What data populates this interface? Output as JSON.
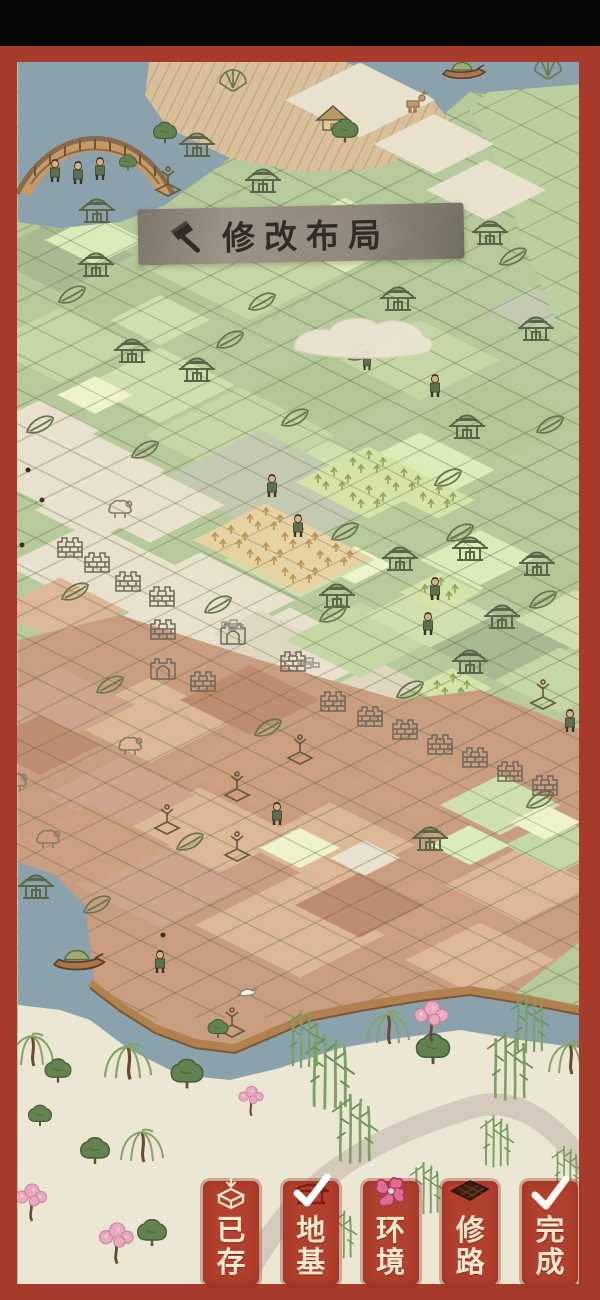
{
  "banner": {
    "label": "修改布局",
    "icon": "hammer-icon",
    "bg_color": "#8d8279",
    "text_color": "#322b21"
  },
  "toolbar": {
    "button_color": "#b2402e",
    "label_color": "#f3e8d0",
    "buttons": [
      {
        "id": "saved",
        "label": "已存",
        "chars": [
          "已",
          "存"
        ],
        "icon": "save-box-icon",
        "selected": false
      },
      {
        "id": "foundation",
        "label": "地基",
        "chars": [
          "地",
          "基"
        ],
        "icon": "building-check-icon",
        "selected": true
      },
      {
        "id": "environment",
        "label": "环境",
        "chars": [
          "环",
          "境"
        ],
        "icon": "flower-icon",
        "selected": false
      },
      {
        "id": "road",
        "label": "修路",
        "chars": [
          "修",
          "路"
        ],
        "icon": "road-tile-icon",
        "selected": false
      },
      {
        "id": "finish",
        "label": "完成",
        "chars": [
          "完",
          "成"
        ],
        "icon": "check-icon",
        "selected": false
      }
    ]
  },
  "frame": {
    "border_color": "#a63b2b",
    "top_bar_color": "#070707"
  },
  "scene": {
    "palette": {
      "lg": "#cfe0ae",
      "ml": "#c5d7a4",
      "mg": "#b3c795",
      "sg": "#a6bb92",
      "pg": "#dcecb8",
      "yg": "#eef3cb",
      "cr": "#e8e1cd",
      "cd": "#ded7c2",
      "gs": "#c2cbb2",
      "tl": "#dcb896",
      "td": "#cc9f7f",
      "tp": "#cfa48d",
      "tb": "#bd8e6e",
      "pt": "#e6d2a2",
      "pgn": "#d4e4a9",
      "water": "#8ba2ad",
      "bank": "#ece6d4",
      "dirt": "#c99e80",
      "base_green": "#b7ca9b"
    },
    "patches_upper": [
      [
        "sg",
        60,
        255,
        150
      ],
      [
        "mg",
        140,
        300,
        160
      ],
      [
        "ml",
        250,
        265,
        220
      ],
      [
        "pg",
        345,
        235,
        150
      ],
      [
        "ml",
        60,
        345,
        150
      ],
      [
        "lg",
        160,
        385,
        150
      ],
      [
        "ml",
        240,
        435,
        190
      ],
      [
        "mg",
        330,
        390,
        160
      ],
      [
        "ml",
        420,
        360,
        160
      ],
      [
        "mg",
        500,
        420,
        160
      ],
      [
        "lg",
        330,
        480,
        160
      ],
      [
        "pg",
        420,
        470,
        150
      ],
      [
        "lg",
        160,
        320,
        100
      ],
      [
        "pg",
        95,
        240,
        100
      ],
      [
        "gs",
        260,
        480,
        200
      ],
      [
        "gs",
        320,
        500,
        140
      ],
      [
        "cr",
        70,
        470,
        190
      ],
      [
        "cr",
        150,
        505,
        150
      ],
      [
        "cr",
        90,
        565,
        170
      ],
      [
        "cr",
        40,
        430,
        120
      ],
      [
        "cr",
        95,
        510,
        120
      ],
      [
        "cr",
        200,
        600,
        190
      ],
      [
        "cr",
        290,
        655,
        190
      ],
      [
        "cd",
        380,
        700,
        150
      ],
      [
        "cd",
        260,
        640,
        120
      ],
      [
        "cr",
        150,
        640,
        150
      ],
      [
        "yg",
        355,
        565,
        75
      ],
      [
        "yg",
        95,
        395,
        75
      ],
      [
        "lg",
        300,
        560,
        150
      ],
      [
        "pg",
        480,
        560,
        120
      ],
      [
        "ml",
        360,
        640,
        150
      ],
      [
        "sg",
        500,
        645,
        150
      ],
      [
        "mg",
        540,
        585,
        120
      ],
      [
        "lg",
        430,
        615,
        130
      ],
      [
        "ml",
        560,
        680,
        130
      ],
      [
        "mg",
        430,
        720,
        150
      ],
      [
        "ml",
        540,
        765,
        120
      ],
      [
        "lg",
        330,
        770,
        120
      ],
      [
        "lg",
        575,
        620,
        120
      ],
      [
        "tl",
        60,
        610,
        130
      ],
      [
        "pt",
        265,
        522,
        74
      ],
      [
        "pt",
        300,
        540,
        74
      ],
      [
        "pt",
        335,
        558,
        74
      ],
      [
        "pt",
        265,
        557,
        74
      ],
      [
        "pt",
        300,
        575,
        74
      ],
      [
        "pt",
        230,
        540,
        74
      ],
      [
        "pgn",
        333,
        482,
        74
      ],
      [
        "pgn",
        368,
        465,
        74
      ],
      [
        "pgn",
        403,
        483,
        74
      ],
      [
        "pgn",
        368,
        500,
        74
      ],
      [
        "pgn",
        438,
        500,
        74
      ],
      [
        "gs",
        532,
        310,
        90
      ],
      [
        "pgn",
        440,
        592,
        80
      ],
      [
        "pgn",
        452,
        688,
        80
      ]
    ],
    "patches_lower": [
      [
        "tl",
        150,
        720,
        170
      ],
      [
        "td",
        260,
        765,
        170
      ],
      [
        "tl",
        200,
        835,
        190
      ],
      [
        "tl",
        330,
        845,
        170
      ],
      [
        "tp",
        120,
        795,
        150
      ],
      [
        "td",
        420,
        785,
        150
      ],
      [
        "tl",
        300,
        925,
        210
      ],
      [
        "td",
        430,
        915,
        170
      ],
      [
        "tp",
        160,
        885,
        170
      ],
      [
        "tl",
        520,
        885,
        150
      ],
      [
        "tp",
        60,
        705,
        150
      ],
      [
        "tb",
        40,
        745,
        120
      ],
      [
        "td",
        90,
        845,
        160
      ],
      [
        "tb",
        250,
        700,
        140
      ],
      [
        "tb",
        360,
        905,
        130
      ],
      [
        "tl",
        480,
        960,
        150
      ],
      [
        "lg",
        500,
        805,
        120
      ],
      [
        "ml",
        560,
        845,
        110
      ],
      [
        "pg",
        470,
        845,
        80
      ],
      [
        "yg",
        300,
        848,
        80
      ],
      [
        "cr",
        365,
        858,
        70
      ],
      [
        "yg",
        545,
        822,
        70
      ]
    ],
    "float_patches": [
      [
        "cr",
        360,
        100,
        150
      ],
      [
        "cr",
        434,
        144,
        120
      ],
      [
        "cr",
        486,
        190,
        120
      ]
    ],
    "decorations": [
      [
        "bridge",
        95,
        152
      ],
      [
        "boat",
        463,
        72
      ],
      [
        "boat",
        78,
        962,
        1.2
      ],
      [
        "hut",
        333,
        120
      ],
      [
        "deer",
        415,
        103
      ],
      [
        "tree",
        165,
        132,
        0.8
      ],
      [
        "tree",
        345,
        130,
        0.9
      ],
      [
        "tree",
        128,
        162,
        0.6
      ],
      [
        "house",
        97,
        212
      ],
      [
        "house",
        96,
        266
      ],
      [
        "house",
        132,
        352
      ],
      [
        "house",
        197,
        371
      ],
      [
        "house",
        263,
        182
      ],
      [
        "house",
        197,
        146
      ],
      [
        "house",
        490,
        234
      ],
      [
        "house",
        536,
        330
      ],
      [
        "house",
        398,
        300
      ],
      [
        "house",
        467,
        428
      ],
      [
        "house",
        400,
        560
      ],
      [
        "house",
        470,
        550
      ],
      [
        "house",
        537,
        565
      ],
      [
        "house",
        337,
        597
      ],
      [
        "house",
        502,
        618
      ],
      [
        "house",
        470,
        663
      ],
      [
        "house",
        36,
        888
      ],
      [
        "house",
        430,
        840
      ],
      [
        "leaf",
        72,
        295
      ],
      [
        "leaf",
        40,
        425
      ],
      [
        "leaf",
        75,
        592
      ],
      [
        "leaf",
        110,
        685
      ],
      [
        "leaf",
        218,
        605
      ],
      [
        "leaf",
        145,
        450
      ],
      [
        "leaf",
        262,
        302
      ],
      [
        "leaf",
        362,
        352
      ],
      [
        "leaf",
        513,
        257
      ],
      [
        "leaf",
        295,
        418
      ],
      [
        "leaf",
        448,
        478
      ],
      [
        "leaf",
        543,
        600
      ],
      [
        "leaf",
        345,
        532
      ],
      [
        "leaf",
        333,
        614
      ],
      [
        "leaf",
        460,
        533
      ],
      [
        "leaf",
        97,
        905
      ],
      [
        "leaf",
        268,
        728
      ],
      [
        "leaf",
        190,
        842
      ],
      [
        "leaf",
        540,
        800
      ],
      [
        "leaf",
        410,
        690
      ],
      [
        "leaf",
        230,
        340
      ],
      [
        "leaf",
        550,
        425
      ],
      [
        "brick",
        70,
        548
      ],
      [
        "brick",
        97,
        563
      ],
      [
        "brick",
        128,
        582
      ],
      [
        "brick",
        162,
        597
      ],
      [
        "brick",
        163,
        630
      ],
      [
        "brick",
        203,
        682
      ],
      [
        "brick",
        293,
        662
      ],
      [
        "brick",
        333,
        702
      ],
      [
        "brick",
        370,
        717
      ],
      [
        "brick",
        405,
        730
      ],
      [
        "brick",
        440,
        745
      ],
      [
        "brick",
        475,
        758
      ],
      [
        "brick",
        510,
        772
      ],
      [
        "brick",
        545,
        786
      ],
      [
        "gate",
        233,
        635
      ],
      [
        "gate",
        163,
        670
      ],
      [
        "crops-t",
        265,
        520
      ],
      [
        "crops-t",
        300,
        538
      ],
      [
        "crops-t",
        335,
        556
      ],
      [
        "crops-t",
        265,
        555
      ],
      [
        "crops-t",
        300,
        573
      ],
      [
        "crops-t",
        230,
        538
      ],
      [
        "crops-g",
        333,
        480
      ],
      [
        "crops-g",
        368,
        463
      ],
      [
        "crops-g",
        403,
        481
      ],
      [
        "crops-g",
        368,
        498
      ],
      [
        "crops-g",
        438,
        498
      ],
      [
        "crops-g",
        440,
        590
      ],
      [
        "crops-g",
        452,
        686
      ],
      [
        "person",
        55,
        172
      ],
      [
        "person",
        78,
        174
      ],
      [
        "person",
        100,
        170
      ],
      [
        "person",
        272,
        487
      ],
      [
        "person",
        298,
        527
      ],
      [
        "person",
        435,
        387
      ],
      [
        "person",
        367,
        362,
        0.8
      ],
      [
        "person",
        435,
        590
      ],
      [
        "person",
        428,
        625
      ],
      [
        "person",
        277,
        815
      ],
      [
        "person",
        570,
        722
      ],
      [
        "person",
        160,
        963
      ],
      [
        "sheep",
        130,
        747
      ],
      [
        "sheep",
        48,
        840
      ],
      [
        "sheep",
        120,
        510
      ],
      [
        "sheep",
        15,
        783
      ],
      [
        "plant",
        167,
        820
      ],
      [
        "plant",
        237,
        787
      ],
      [
        "plant",
        300,
        750
      ],
      [
        "plant",
        237,
        847
      ],
      [
        "plant",
        543,
        695
      ],
      [
        "plant",
        168,
        182
      ],
      [
        "plant",
        232,
        1023
      ],
      [
        "fan",
        233,
        77
      ],
      [
        "fan",
        548,
        65
      ],
      [
        "bird",
        247,
        992
      ],
      [
        "cloud",
        365,
        340
      ],
      [
        "stone",
        232,
        625
      ],
      [
        "stone",
        308,
        663
      ],
      [
        "dot",
        28,
        470
      ],
      [
        "dot",
        42,
        500
      ],
      [
        "dot",
        22,
        545
      ],
      [
        "dot",
        163,
        935
      ],
      [
        "willow",
        32,
        1032
      ],
      [
        "willow",
        128,
        1042,
        1.1
      ],
      [
        "willow",
        142,
        1128
      ],
      [
        "willow",
        388,
        1010
      ],
      [
        "willow",
        570,
        1040
      ],
      [
        "tree",
        187,
        1073,
        1.1
      ],
      [
        "tree",
        433,
        1048,
        1.15
      ],
      [
        "tree",
        480,
        1215
      ],
      [
        "tree",
        152,
        1232
      ],
      [
        "tree",
        58,
        1070,
        0.9
      ],
      [
        "tree",
        595,
        988
      ],
      [
        "tree",
        95,
        1150
      ],
      [
        "tree",
        40,
        1115,
        0.8
      ],
      [
        "tree",
        218,
        1028,
        0.7
      ],
      [
        "blossom",
        430,
        1013,
        1.1
      ],
      [
        "blossom",
        250,
        1095,
        0.8
      ],
      [
        "blossom",
        30,
        1195
      ],
      [
        "blossom",
        115,
        1235,
        1.1
      ],
      [
        "bamboo",
        330,
        1060,
        1.3
      ],
      [
        "bamboo",
        355,
        1118,
        1.2
      ],
      [
        "bamboo",
        305,
        1030
      ],
      [
        "bamboo",
        510,
        1055,
        1.2
      ],
      [
        "bamboo",
        530,
        1015
      ],
      [
        "bamboo",
        497,
        1133,
        0.9
      ],
      [
        "bamboo",
        427,
        1180,
        0.9
      ],
      [
        "bamboo",
        567,
        1162,
        0.8
      ],
      [
        "bamboo",
        340,
        1225,
        0.9
      ]
    ]
  }
}
